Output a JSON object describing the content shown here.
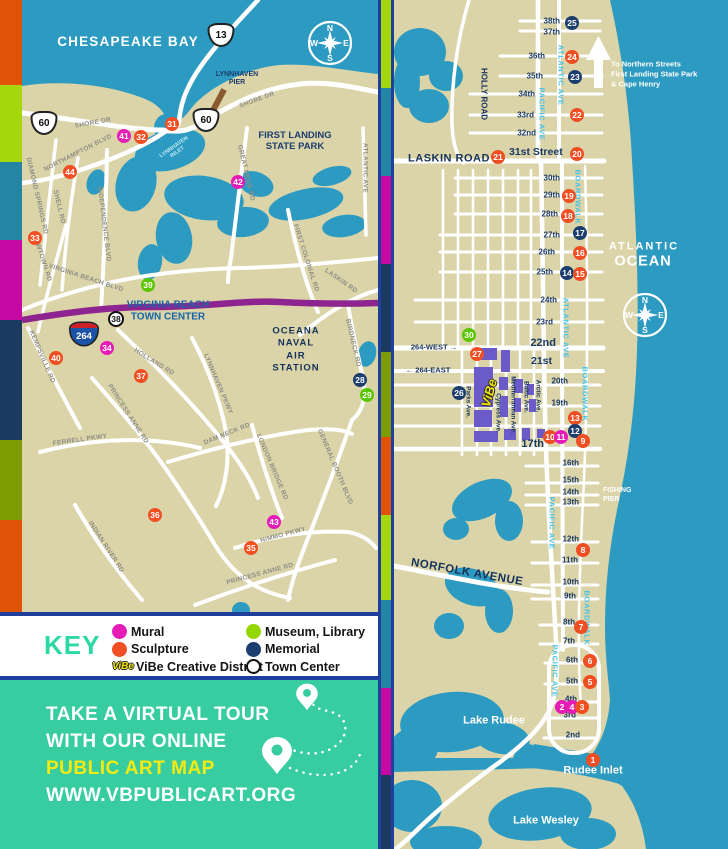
{
  "palette": {
    "water": "#2D9BC1",
    "land": "#DBD4A8",
    "road": "#FFFFFF",
    "highway_purple": "#8E2490",
    "vibe_purple": "#6A5BC8",
    "border_blue": "#1F3F9C",
    "promo_teal": "#38CDA0",
    "key_title_teal": "#2BD9A5",
    "promo_yellow": "#F6EB0F",
    "pier_brown": "#8A5A30",
    "marker": {
      "red": "#F04E23",
      "magenta": "#E51CB5",
      "green": "#5BC500",
      "navy": "#1C3E6E"
    }
  },
  "stripes": {
    "left": [
      {
        "color": "#E05206",
        "h": 85
      },
      {
        "color": "#A6D70C",
        "h": 77
      },
      {
        "color": "#2585A5",
        "h": 78
      },
      {
        "color": "#C609A3",
        "h": 80
      },
      {
        "color": "#1A3A5F",
        "h": 120
      },
      {
        "color": "#7D9C04",
        "h": 80
      },
      {
        "color": "#E05206",
        "h": 92
      }
    ],
    "divider": [
      {
        "color": "#A6D70C",
        "h": 88
      },
      {
        "color": "#2585A5",
        "h": 88
      },
      {
        "color": "#C609A3",
        "h": 88
      },
      {
        "color": "#1A3A5F",
        "h": 88
      },
      {
        "color": "#7D9C04",
        "h": 85
      },
      {
        "color": "#E05206",
        "h": 78
      },
      {
        "color": "#A6D70C",
        "h": 85
      },
      {
        "color": "#2585A5",
        "h": 88
      },
      {
        "color": "#C609A3",
        "h": 87
      },
      {
        "color": "#1A3A5F",
        "h": 74
      }
    ]
  },
  "compass_letters": {
    "n": "N",
    "e": "E",
    "s": "S",
    "w": "W"
  },
  "left_map": {
    "compass": {
      "x": 330,
      "y": 43
    },
    "area_labels": [
      {
        "id": "chesapeake-bay-label",
        "t": "CHESAPEAKE BAY",
        "x": 128,
        "y": 42,
        "size": 13.5,
        "color": "#FFFFFF",
        "ls": 1.2
      },
      {
        "id": "lynnhaven-pier-label",
        "t": "LYNNHAVEN\nPIER",
        "x": 237,
        "y": 79,
        "size": 7,
        "color": "#1C3E6E"
      },
      {
        "id": "first-landing-label",
        "t": "FIRST LANDING\nSTATE PARK",
        "x": 295,
        "y": 142,
        "size": 9.5,
        "color": "#1C3E6E"
      },
      {
        "id": "town-center-label",
        "t": "VIRGINIA BEACH\nTOWN CENTER",
        "x": 168,
        "y": 311,
        "size": 10,
        "color": "#1565A8"
      },
      {
        "id": "oceana-label",
        "t": "OCEANA\nNAVAL\nAIR\nSTATION",
        "x": 296,
        "y": 350,
        "size": 9.5,
        "color": "#16325A",
        "ls": 1,
        "lh": 1.3
      },
      {
        "id": "lynnhaven-inlet-label",
        "t": "LYNNHAVEN\nINLET",
        "x": 176,
        "y": 150,
        "size": 5.5,
        "color": "#BFE8F5",
        "rot": -35
      }
    ],
    "road_labels": [
      {
        "t": "SHORE DR",
        "x": 93,
        "y": 123,
        "rot": -10
      },
      {
        "t": "SHORE DR",
        "x": 257,
        "y": 100,
        "rot": -20
      },
      {
        "t": "NORTHAMPTON BLVD",
        "x": 78,
        "y": 153,
        "rot": -27
      },
      {
        "t": "DIAMOND SPRINGS RD",
        "x": 37,
        "y": 196,
        "rot": 77
      },
      {
        "t": "SHELL RD",
        "x": 59,
        "y": 207,
        "rot": 77
      },
      {
        "t": "NEWTOWN RD",
        "x": 42,
        "y": 258,
        "rot": 72
      },
      {
        "t": "INDEPENDENCE BLVD",
        "x": 104,
        "y": 224,
        "rot": 83
      },
      {
        "t": "VIRGINIA BEACH BLVD",
        "x": 86,
        "y": 278,
        "rot": 18
      },
      {
        "t": "GREAT NECK RD",
        "x": 246,
        "y": 173,
        "rot": 77
      },
      {
        "t": "FIRST COLONIAL RD",
        "x": 306,
        "y": 258,
        "rot": 72
      },
      {
        "t": "LASKIN RD",
        "x": 341,
        "y": 281,
        "rot": 35
      },
      {
        "t": "ATLANTIC AVE",
        "x": 365,
        "y": 168,
        "rot": 90
      },
      {
        "t": "KEMPSVILLE RD",
        "x": 42,
        "y": 357,
        "rot": 67
      },
      {
        "t": "HOLLAND RD",
        "x": 154,
        "y": 362,
        "rot": 32
      },
      {
        "t": "LYNNHAVEN PKWY",
        "x": 218,
        "y": 384,
        "rot": 67
      },
      {
        "t": "PRINCESS ANNE RD",
        "x": 128,
        "y": 414,
        "rot": 57
      },
      {
        "t": "FERRELL PKWY",
        "x": 80,
        "y": 440,
        "rot": -8
      },
      {
        "t": "DAM NECK RD",
        "x": 227,
        "y": 434,
        "rot": -22
      },
      {
        "t": "LONDON BRIDGE RD",
        "x": 272,
        "y": 467,
        "rot": 67
      },
      {
        "t": "GENERAL BOOTH BLVD",
        "x": 335,
        "y": 467,
        "rot": 67
      },
      {
        "t": "BIRDNECK RD",
        "x": 353,
        "y": 343,
        "rot": 77
      },
      {
        "t": "INDIAN RIVER RD",
        "x": 106,
        "y": 547,
        "rot": 57
      },
      {
        "t": "NIMMO PKWY",
        "x": 283,
        "y": 535,
        "rot": -15
      },
      {
        "t": "PRINCESS ANNE RD",
        "x": 260,
        "y": 574,
        "rot": -15
      }
    ],
    "shields": [
      {
        "type": "us",
        "num": "13",
        "x": 221,
        "y": 35
      },
      {
        "type": "us",
        "num": "60",
        "x": 44,
        "y": 123
      },
      {
        "type": "us",
        "num": "60",
        "x": 206,
        "y": 120
      },
      {
        "type": "i264",
        "num": "264",
        "x": 84,
        "y": 334
      }
    ],
    "markers": [
      {
        "n": "31",
        "c": "red",
        "x": 172,
        "y": 124
      },
      {
        "n": "41",
        "c": "magenta",
        "x": 124,
        "y": 136
      },
      {
        "n": "32",
        "c": "red",
        "x": 141,
        "y": 137
      },
      {
        "n": "44",
        "c": "red",
        "x": 70,
        "y": 172
      },
      {
        "n": "42",
        "c": "magenta",
        "x": 238,
        "y": 182
      },
      {
        "n": "33",
        "c": "red",
        "x": 35,
        "y": 238
      },
      {
        "n": "39",
        "c": "green",
        "x": 148,
        "y": 285
      },
      {
        "n": "38",
        "c": "town",
        "x": 116,
        "y": 319
      },
      {
        "n": "34",
        "c": "magenta",
        "x": 107,
        "y": 348
      },
      {
        "n": "40",
        "c": "red",
        "x": 56,
        "y": 358
      },
      {
        "n": "37",
        "c": "red",
        "x": 141,
        "y": 376
      },
      {
        "n": "28",
        "c": "navy",
        "x": 360,
        "y": 380
      },
      {
        "n": "29",
        "c": "green",
        "x": 367,
        "y": 395
      },
      {
        "n": "36",
        "c": "red",
        "x": 155,
        "y": 515
      },
      {
        "n": "43",
        "c": "magenta",
        "x": 274,
        "y": 522
      },
      {
        "n": "35",
        "c": "red",
        "x": 251,
        "y": 548
      }
    ]
  },
  "right_map": {
    "compass": {
      "x": 645,
      "y": 315
    },
    "vibe_logo_text": "ViBe",
    "street_labels": [
      {
        "t": "38th",
        "x": 560,
        "y": 21
      },
      {
        "t": "37th",
        "x": 560,
        "y": 32
      },
      {
        "t": "36th",
        "x": 545,
        "y": 56
      },
      {
        "t": "35th",
        "x": 543,
        "y": 76
      },
      {
        "t": "34th",
        "x": 535,
        "y": 94
      },
      {
        "t": "33rd",
        "x": 534,
        "y": 115
      },
      {
        "t": "32nd",
        "x": 536,
        "y": 133
      },
      {
        "t": "31st Street",
        "x": 509,
        "y": 152,
        "size": 10.5,
        "align": "left"
      },
      {
        "t": "30th",
        "x": 560,
        "y": 178
      },
      {
        "t": "29th",
        "x": 560,
        "y": 195
      },
      {
        "t": "28th",
        "x": 558,
        "y": 214
      },
      {
        "t": "27th",
        "x": 560,
        "y": 235
      },
      {
        "t": "26th",
        "x": 555,
        "y": 252
      },
      {
        "t": "25th",
        "x": 553,
        "y": 272
      },
      {
        "t": "24th",
        "x": 557,
        "y": 300
      },
      {
        "t": "23rd",
        "x": 553,
        "y": 322
      },
      {
        "t": "22nd",
        "x": 556,
        "y": 343,
        "size": 11
      },
      {
        "t": "21st",
        "x": 552,
        "y": 361,
        "size": 10.5
      },
      {
        "t": "20th",
        "x": 568,
        "y": 381
      },
      {
        "t": "19th",
        "x": 568,
        "y": 403
      },
      {
        "t": "17th",
        "x": 544,
        "y": 444,
        "size": 11
      },
      {
        "t": "16th",
        "x": 579,
        "y": 463
      },
      {
        "t": "15th",
        "x": 579,
        "y": 480
      },
      {
        "t": "14th",
        "x": 579,
        "y": 492
      },
      {
        "t": "13th",
        "x": 579,
        "y": 502
      },
      {
        "t": "12th",
        "x": 579,
        "y": 539
      },
      {
        "t": "11th",
        "x": 578,
        "y": 560
      },
      {
        "t": "10th",
        "x": 579,
        "y": 582
      },
      {
        "t": "9th",
        "x": 576,
        "y": 596
      },
      {
        "t": "8th",
        "x": 575,
        "y": 622
      },
      {
        "t": "7th",
        "x": 575,
        "y": 641
      },
      {
        "t": "6th",
        "x": 578,
        "y": 660
      },
      {
        "t": "5th",
        "x": 578,
        "y": 681
      },
      {
        "t": "4th",
        "x": 577,
        "y": 699
      },
      {
        "t": "3rd",
        "x": 576,
        "y": 715
      },
      {
        "t": "2nd",
        "x": 580,
        "y": 735
      }
    ],
    "avenue_labels": [
      {
        "t": "ATLANTIC AVE",
        "x": 561,
        "y": 75
      },
      {
        "t": "PACIFIC AVE",
        "x": 542,
        "y": 114
      },
      {
        "t": "BOARDWALK",
        "x": 578,
        "y": 197
      },
      {
        "t": "ATLANTIC AVE",
        "x": 566,
        "y": 328
      },
      {
        "t": "BOARDWALK",
        "x": 585,
        "y": 394
      },
      {
        "t": "PACIFIC AVE",
        "x": 552,
        "y": 523
      },
      {
        "t": "BOARDWALK",
        "x": 587,
        "y": 618
      },
      {
        "t": "PACIFIC AVE",
        "x": 555,
        "y": 671
      }
    ],
    "vibe_streets": [
      {
        "t": "Parks Ave.",
        "x": 468,
        "y": 402
      },
      {
        "t": "Cypress Ave.",
        "x": 498,
        "y": 413
      },
      {
        "t": "Mediterranean Ave.",
        "x": 513,
        "y": 405
      },
      {
        "t": "Baltic Ave.",
        "x": 526,
        "y": 397
      },
      {
        "t": "Arctic Ave.",
        "x": 538,
        "y": 396
      }
    ],
    "area_labels": [
      {
        "id": "atlantic-label",
        "t": "ATLANTIC",
        "x": 644,
        "y": 247,
        "size": 11,
        "color": "#FFFFFF",
        "ls": 2
      },
      {
        "id": "ocean-label",
        "t": "OCEAN",
        "x": 643,
        "y": 262,
        "size": 14.5,
        "color": "#FFFFFF",
        "ls": 1
      },
      {
        "id": "to-northern-label",
        "t": "To Northern Streets\nFirst Landing State Park\n& Cape Henry",
        "x": 611,
        "y": 74,
        "size": 7.5,
        "color": "#FFFFFF",
        "align": "left",
        "lh": 1.3
      },
      {
        "id": "laskin-road-label",
        "t": "LASKIN ROAD",
        "x": 449,
        "y": 159,
        "size": 11,
        "color": "#16325A",
        "ls": 0.5
      },
      {
        "id": "holly-road-label",
        "t": "HOLLY ROAD",
        "x": 484,
        "y": 94,
        "size": 8,
        "color": "#16325A",
        "rot": 90
      },
      {
        "id": "norfolk-avenue-label",
        "t": "NORFOLK AVENUE",
        "x": 467,
        "y": 573,
        "size": 11.5,
        "color": "#16325A",
        "rot": 10,
        "ls": 0.5
      },
      {
        "id": "fishing-pier-label",
        "t": "FISHING\nPIER",
        "x": 603,
        "y": 495,
        "size": 7,
        "color": "#FFFFFF",
        "align": "left",
        "lh": 1.3
      },
      {
        "id": "lake-rudee-label",
        "t": "Lake Rudee",
        "x": 494,
        "y": 721,
        "size": 11,
        "color": "#FFFFFF"
      },
      {
        "id": "lake-wesley-label",
        "t": "Lake Wesley",
        "x": 546,
        "y": 821,
        "size": 11,
        "color": "#FFFFFF"
      },
      {
        "id": "rudee-inlet-label",
        "t": "Rudee Inlet",
        "x": 593,
        "y": 771,
        "size": 11,
        "color": "#FFFFFF"
      },
      {
        "id": "i264-west-label",
        "t": "264-WEST  →",
        "x": 434,
        "y": 348,
        "size": 7.5,
        "color": "#16325A"
      },
      {
        "id": "i264-east-label",
        "t": "←  264-EAST",
        "x": 428,
        "y": 371,
        "size": 7.5,
        "color": "#16325A"
      }
    ],
    "markers": [
      {
        "n": "25",
        "c": "navy",
        "x": 572,
        "y": 23
      },
      {
        "n": "24",
        "c": "red",
        "x": 572,
        "y": 57
      },
      {
        "n": "23",
        "c": "navy",
        "x": 575,
        "y": 77
      },
      {
        "n": "22",
        "c": "red",
        "x": 577,
        "y": 115
      },
      {
        "n": "21",
        "c": "red",
        "x": 498,
        "y": 157
      },
      {
        "n": "20",
        "c": "red",
        "x": 577,
        "y": 154
      },
      {
        "n": "19",
        "c": "red",
        "x": 569,
        "y": 196
      },
      {
        "n": "18",
        "c": "red",
        "x": 568,
        "y": 216
      },
      {
        "n": "17",
        "c": "navy",
        "x": 580,
        "y": 233
      },
      {
        "n": "16",
        "c": "red",
        "x": 580,
        "y": 253
      },
      {
        "n": "14",
        "c": "navy",
        "x": 567,
        "y": 273
      },
      {
        "n": "15",
        "c": "red",
        "x": 580,
        "y": 274
      },
      {
        "n": "30",
        "c": "green",
        "x": 469,
        "y": 335
      },
      {
        "n": "27",
        "c": "red",
        "x": 477,
        "y": 354
      },
      {
        "n": "26",
        "c": "navy",
        "x": 459,
        "y": 393
      },
      {
        "n": "13",
        "c": "red",
        "x": 575,
        "y": 418
      },
      {
        "n": "12",
        "c": "navy",
        "x": 575,
        "y": 431
      },
      {
        "n": "10",
        "c": "red",
        "x": 550,
        "y": 437
      },
      {
        "n": "11",
        "c": "magenta",
        "x": 561,
        "y": 437
      },
      {
        "n": "9",
        "c": "red",
        "x": 583,
        "y": 441
      },
      {
        "n": "8",
        "c": "red",
        "x": 583,
        "y": 550
      },
      {
        "n": "7",
        "c": "red",
        "x": 581,
        "y": 627
      },
      {
        "n": "6",
        "c": "red",
        "x": 590,
        "y": 661
      },
      {
        "n": "5",
        "c": "red",
        "x": 590,
        "y": 682
      },
      {
        "n": "2",
        "c": "magenta",
        "x": 562,
        "y": 707
      },
      {
        "n": "4",
        "c": "magenta",
        "x": 572,
        "y": 707
      },
      {
        "n": "3",
        "c": "red",
        "x": 582,
        "y": 707
      },
      {
        "n": "1",
        "c": "red",
        "x": 593,
        "y": 760
      }
    ]
  },
  "key": {
    "title": "KEY",
    "vibe_logo_text": "ViBe",
    "items": [
      {
        "label": "Mural",
        "swatch": "dot",
        "color": "#E51CB5",
        "col": 1
      },
      {
        "label": "Sculpture",
        "swatch": "dot",
        "color": "#F04E23",
        "col": 1
      },
      {
        "label": "ViBe Creative District",
        "swatch": "vibe",
        "col": 1
      },
      {
        "label": "Museum, Library",
        "swatch": "dot",
        "color": "#96D600",
        "col": 2
      },
      {
        "label": "Memorial",
        "swatch": "dot",
        "color": "#1C3E6E",
        "col": 2
      },
      {
        "label": "Town Center",
        "swatch": "ring",
        "col": 2
      }
    ]
  },
  "promo": {
    "lines": [
      {
        "t": "TAKE A VIRTUAL TOUR",
        "color": "#FFFFFF"
      },
      {
        "t": "WITH OUR ONLINE",
        "color": "#FFFFFF"
      },
      {
        "t": "PUBLIC ART MAP",
        "color": "#F6EB0F"
      },
      {
        "t": "WWW.VBPUBLICART.ORG",
        "color": "#FFFFFF"
      }
    ]
  }
}
